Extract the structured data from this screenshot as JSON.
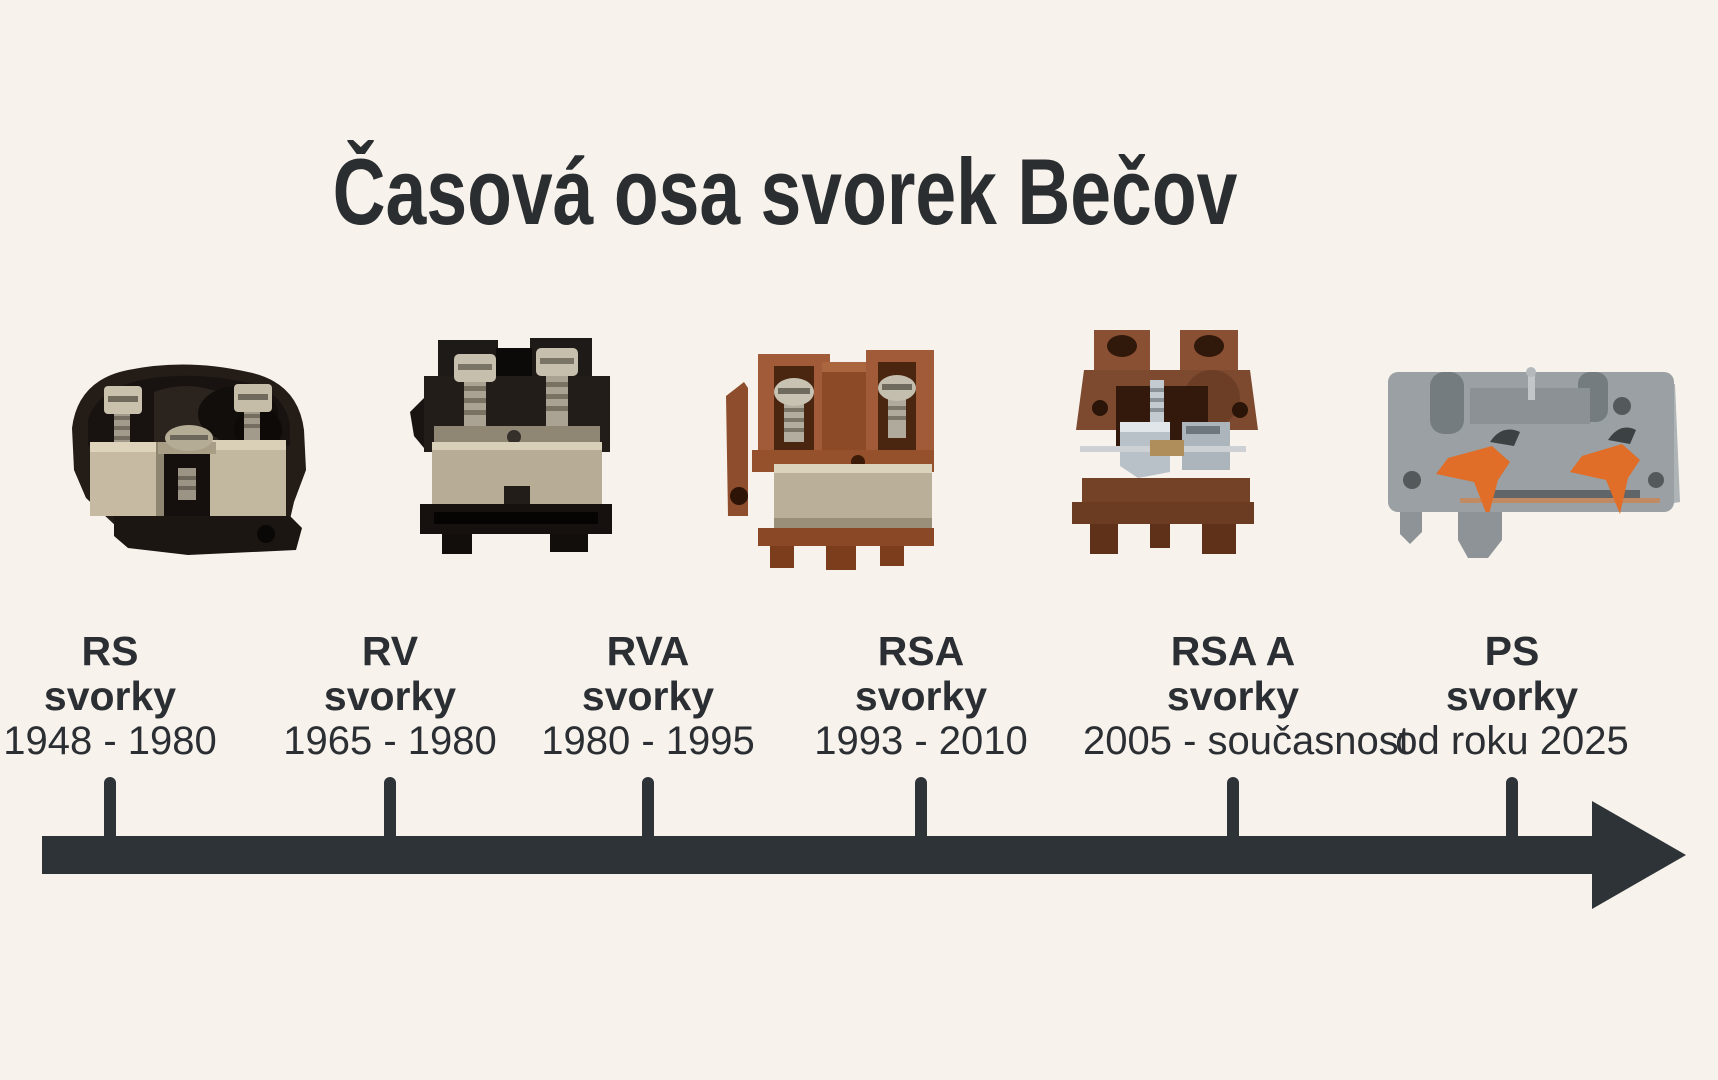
{
  "page": {
    "title": "Časová osa svorek Bečov",
    "colors": {
      "background": "#f7f3ec",
      "text": "#2b2f33",
      "arrow": "#2e3338",
      "terminal_brown": "#9a5a38",
      "terminal_dark_brown": "#7d4a30",
      "terminal_black": "#1e1916",
      "terminal_gray": "#9aa0a3",
      "lever_orange": "#e06e28",
      "metal_nickel": "#b7ac96"
    }
  },
  "timeline": {
    "items": [
      {
        "name": "RS",
        "kind": "svorky",
        "period": "1948 - 1980"
      },
      {
        "name": "RV",
        "kind": "svorky",
        "period": "1965 - 1980"
      },
      {
        "name": "RVA",
        "kind": "svorky",
        "period": "1980 - 1995"
      },
      {
        "name": "RSA",
        "kind": "svorky",
        "period": "1993 - 2010"
      },
      {
        "name": "RSA A",
        "kind": "svorky",
        "period": "2005 - současnost"
      },
      {
        "name": "PS",
        "kind": "svorky",
        "period": "od roku 2025"
      }
    ]
  },
  "photos": [
    {
      "icon": "rs-terminal-photo"
    },
    {
      "icon": "rv-terminal-photo"
    },
    {
      "icon": "rva-terminal-photo"
    },
    {
      "icon": "rsa-terminal-photo"
    },
    {
      "icon": "ps-terminal-photo"
    }
  ]
}
